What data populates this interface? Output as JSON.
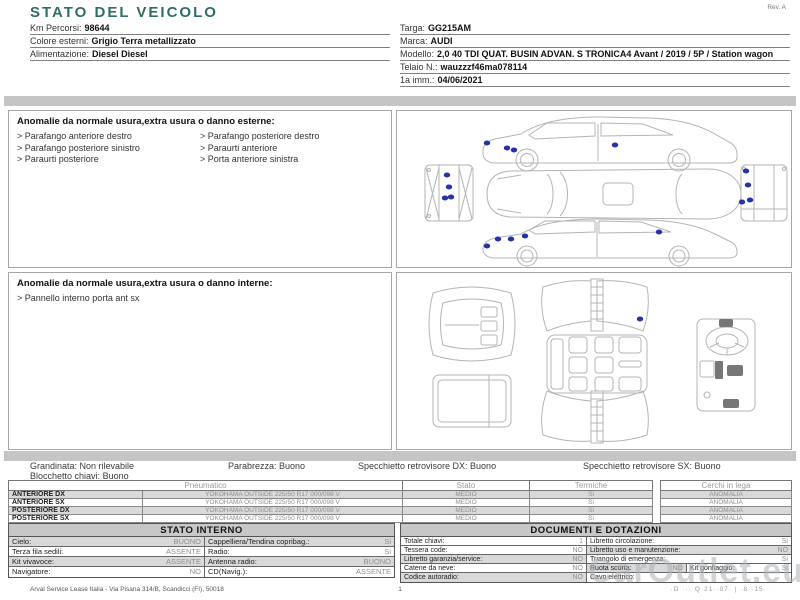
{
  "page": {
    "title": "STATO DEL VEICOLO",
    "rev": "Rev. A"
  },
  "colors": {
    "accent_teal": "#2e6f64",
    "marker_blue": "#2433a6",
    "bar_gray": "#c5c5c5",
    "shade_gray": "#d9d9d9",
    "header_gray": "#c7c7c7"
  },
  "vehicle_info": {
    "left": [
      {
        "label": "Km Percorsi:",
        "value": "98644"
      },
      {
        "label": "Colore esterni:",
        "value": "Grigio Terra metallizzato"
      },
      {
        "label": "Alimentazione:",
        "value": "Diesel Diesel"
      }
    ],
    "right": [
      {
        "label": "Targa:",
        "value": "GG215AM"
      },
      {
        "label": "Marca:",
        "value": "AUDI"
      },
      {
        "label": "Modello:",
        "value": "2,0 40 TDI QUAT. BUSIN ADVAN. S TRONICA4 Avant / 2019 / 5P / Station wagon"
      },
      {
        "label": "Telaio N.:",
        "value": "wauzzzf46ma078114"
      },
      {
        "label": "1a imm.:",
        "value": "04/06/2021"
      }
    ]
  },
  "anomalies_exterior": {
    "header": "Anomalie da normale usura,extra usura o danno esterne:",
    "bullet": ">",
    "col1": [
      "Parafango anteriore destro",
      "Parafango posteriore sinistro",
      "Paraurti posteriore"
    ],
    "col2": [
      "Parafango posteriore destro",
      "Paraurti anteriore",
      "Porta anteriore sinistra"
    ]
  },
  "anomalies_interior": {
    "header": "Anomalie da normale usura,extra usura o danno interne:",
    "bullet": ">",
    "col1": [
      "Pannello interno porta ant sx"
    ],
    "col2": []
  },
  "exterior_markers": [
    {
      "x": 50,
      "y": 64
    },
    {
      "x": 52,
      "y": 76
    },
    {
      "x": 48,
      "y": 87
    },
    {
      "x": 54,
      "y": 86
    },
    {
      "x": 90,
      "y": 32
    },
    {
      "x": 110,
      "y": 37
    },
    {
      "x": 117,
      "y": 39
    },
    {
      "x": 218,
      "y": 34
    },
    {
      "x": 90,
      "y": 135
    },
    {
      "x": 101,
      "y": 128
    },
    {
      "x": 114,
      "y": 128
    },
    {
      "x": 128,
      "y": 125
    },
    {
      "x": 262,
      "y": 121
    },
    {
      "x": 349,
      "y": 60
    },
    {
      "x": 351,
      "y": 74
    },
    {
      "x": 345,
      "y": 91
    },
    {
      "x": 353,
      "y": 89
    }
  ],
  "interior_markers": [
    {
      "x": 243,
      "y": 46
    }
  ],
  "condition_line": {
    "items": [
      {
        "label": "Grandinata:",
        "value": "Non rilevabile"
      },
      {
        "label": "Parabrezza:",
        "value": "Buono"
      },
      {
        "label": "Specchietto retrovisore DX:",
        "value": "Buono"
      },
      {
        "label": "Specchietto retrovisore SX:",
        "value": "Buono"
      }
    ],
    "second_line": {
      "label": "Blocchetto chiavi:",
      "value": "Buono"
    }
  },
  "tyre_table": {
    "headers": {
      "pneumatico": "Pneumatico",
      "stato": "Stato",
      "termiche": "Termiche",
      "cerchi": "Cerchi in lega"
    },
    "rows": [
      {
        "position": "ANTERIORE DX",
        "pneumatico": "YOKOHAMA  OUTSIDE 225/50 R17 000/098 V",
        "stato": "MEDIO",
        "termiche": "Si",
        "cerchi": "ANOMALIA"
      },
      {
        "position": "ANTERIORE SX",
        "pneumatico": "YOKOHAMA  OUTSIDE 225/50 R17 000/098 V",
        "stato": "MEDIO",
        "termiche": "Si",
        "cerchi": "ANOMALIA"
      },
      {
        "position": "POSTERIORE DX",
        "pneumatico": "YOKOHAMA  OUTSIDE 225/50 R17 000/098 V",
        "stato": "MEDIO",
        "termiche": "Si",
        "cerchi": "ANOMALIA"
      },
      {
        "position": "POSTERIORE SX",
        "pneumatico": "YOKOHAMA  OUTSIDE 225/50 R17 000/098 V",
        "stato": "MEDIO",
        "termiche": "Si",
        "cerchi": "ANOMALIA"
      }
    ]
  },
  "stato_interno": {
    "title": "STATO INTERNO",
    "rows": [
      [
        {
          "label": "Cielo:",
          "value": "BUONO"
        },
        {
          "label": "Cappelliera/Tendina copribag.:",
          "value": "Si"
        }
      ],
      [
        {
          "label": "Terza fila sedili:",
          "value": "ASSENTE"
        },
        {
          "label": "Radio:",
          "value": "Si"
        }
      ],
      [
        {
          "label": "Kit vivavoce:",
          "value": "ASSENTE"
        },
        {
          "label": "Antenna radio:",
          "value": "BUONO"
        }
      ],
      [
        {
          "label": "Navigatore:",
          "value": "NO"
        },
        {
          "label": "CD(Navig.):",
          "value": "ASSENTE"
        }
      ]
    ]
  },
  "documenti": {
    "title": "DOCUMENTI E DOTAZIONI",
    "rows": [
      [
        {
          "label": "Totale chiavi:",
          "value": "1"
        },
        {
          "label": "Libretto circolazione:",
          "value": "Si"
        }
      ],
      [
        {
          "label": "Tessera code:",
          "value": "NO"
        },
        {
          "label": "Libretto uso e manutenzione:",
          "value": "NO"
        }
      ],
      [
        {
          "label": "Libretto garanzia/service:",
          "value": "NO"
        },
        {
          "label": "Triangolo di emergenza:",
          "value": "Si"
        }
      ],
      [
        {
          "label": "Catene da neve:",
          "value": "NO"
        },
        {
          "label": "Ruota scorta:",
          "value": "NO"
        },
        {
          "label": "Kit gonfiaggio:",
          "value": "Si"
        }
      ],
      [
        {
          "label": "Codice autoradio:",
          "value": "NO"
        },
        {
          "label": "Cavo elettrico:",
          "value": ""
        }
      ]
    ]
  },
  "footer": {
    "left": "Arval Service Lease Italia - Via Pisana 314/B, Scandicci (FI), 50018",
    "page": "1",
    "right": "·D ····Q·21··07· | ·8··15··"
  },
  "watermark": "CarOutlet.eu"
}
